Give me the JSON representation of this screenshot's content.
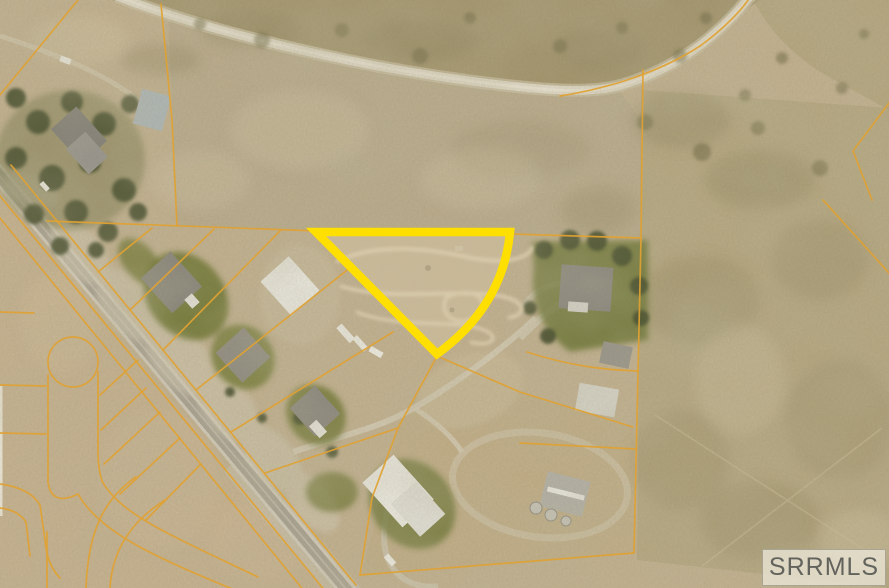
{
  "watermark": {
    "label": "SRRMLS"
  },
  "colors": {
    "highlight_yellow": "#FFDF00",
    "parcel_line_orange": "#DFA233",
    "watermark_bg": "rgba(234,229,214,0.78)",
    "watermark_border": "rgba(140,136,120,0.65)",
    "watermark_text": "#63635D"
  }
}
